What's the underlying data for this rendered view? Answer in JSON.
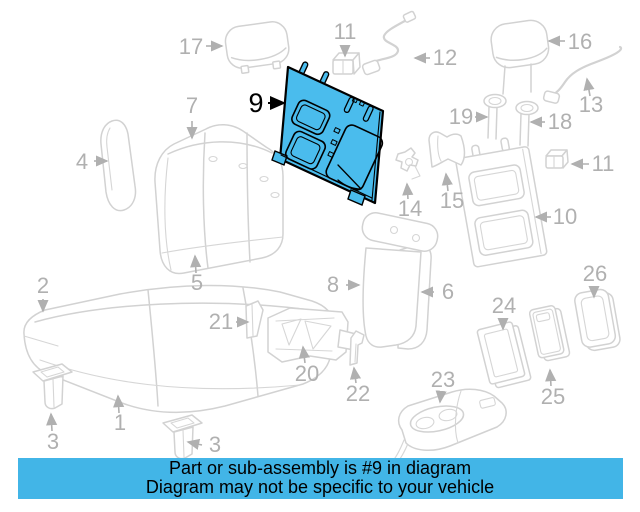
{
  "diagram": {
    "highlighted_part_number": "9",
    "callouts": [
      {
        "num": "17"
      },
      {
        "num": "11"
      },
      {
        "num": "12"
      },
      {
        "num": "16"
      },
      {
        "num": "13"
      },
      {
        "num": "19"
      },
      {
        "num": "18"
      },
      {
        "num": "11"
      },
      {
        "num": "10"
      },
      {
        "num": "9"
      },
      {
        "num": "7"
      },
      {
        "num": "4"
      },
      {
        "num": "14"
      },
      {
        "num": "15"
      },
      {
        "num": "5"
      },
      {
        "num": "8"
      },
      {
        "num": "6"
      },
      {
        "num": "2"
      },
      {
        "num": "21"
      },
      {
        "num": "20"
      },
      {
        "num": "22"
      },
      {
        "num": "1"
      },
      {
        "num": "3"
      },
      {
        "num": "3"
      },
      {
        "num": "23"
      },
      {
        "num": "24"
      },
      {
        "num": "25"
      },
      {
        "num": "26"
      }
    ]
  },
  "banner": {
    "line1": "Part or sub-assembly is #9 in diagram",
    "line2": "Diagram may not be specific to your vehicle"
  },
  "colors": {
    "highlight_fill": "#4abced",
    "highlight_outline": "#000000",
    "line_art": "#d2d2d2",
    "label": "#b0b0b0",
    "banner_background": "#42b5e7",
    "banner_text": "#000000"
  }
}
